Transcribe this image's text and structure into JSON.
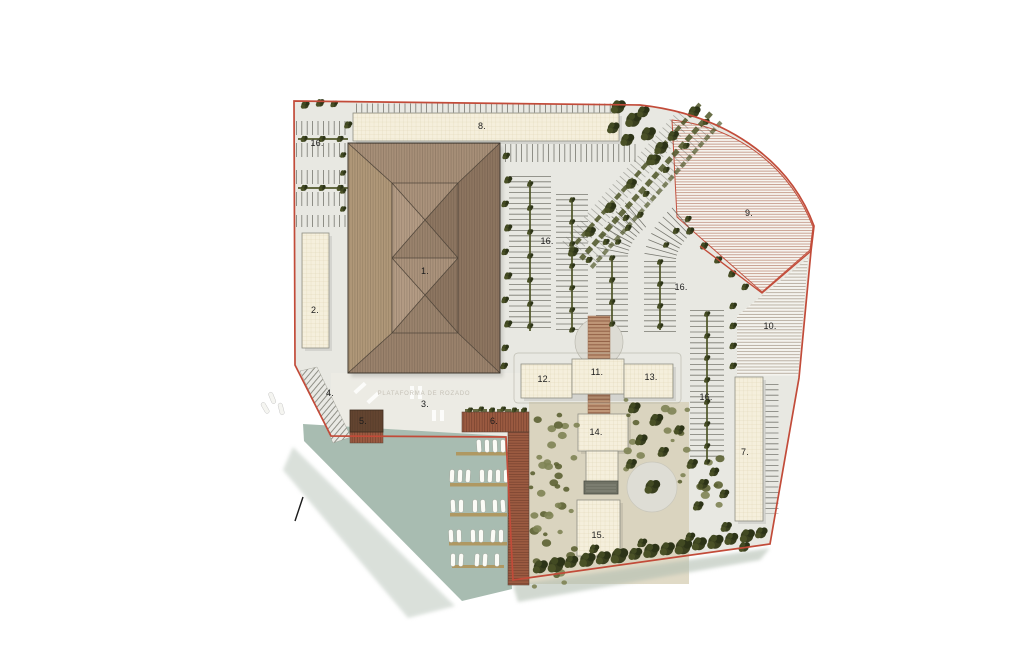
{
  "plan": {
    "watermark": "PLATAFORMA DE ROZADO",
    "labels": [
      {
        "id": "area-8",
        "text": "8."
      },
      {
        "id": "area-16-west",
        "text": "16."
      },
      {
        "id": "area-9",
        "text": "9."
      },
      {
        "id": "area-16-center",
        "text": "16."
      },
      {
        "id": "area-1",
        "text": "1."
      },
      {
        "id": "area-16-east",
        "text": "16."
      },
      {
        "id": "area-2",
        "text": "2."
      },
      {
        "id": "area-10",
        "text": "10."
      },
      {
        "id": "area-12",
        "text": "12."
      },
      {
        "id": "area-11",
        "text": "11."
      },
      {
        "id": "area-13",
        "text": "13."
      },
      {
        "id": "area-4",
        "text": "4."
      },
      {
        "id": "area-3",
        "text": "3."
      },
      {
        "id": "area-16-southeast",
        "text": "16."
      },
      {
        "id": "area-5",
        "text": "5."
      },
      {
        "id": "area-6",
        "text": "6."
      },
      {
        "id": "area-14",
        "text": "14."
      },
      {
        "id": "area-7",
        "text": "7."
      },
      {
        "id": "area-15",
        "text": "15."
      }
    ],
    "colors": {
      "boundary": "#c24b39",
      "roof": "#a28a74",
      "water": "#a8bcb1",
      "building": "#f5efdc",
      "tree": "#3a401f",
      "deck": "#9c5b41"
    }
  }
}
